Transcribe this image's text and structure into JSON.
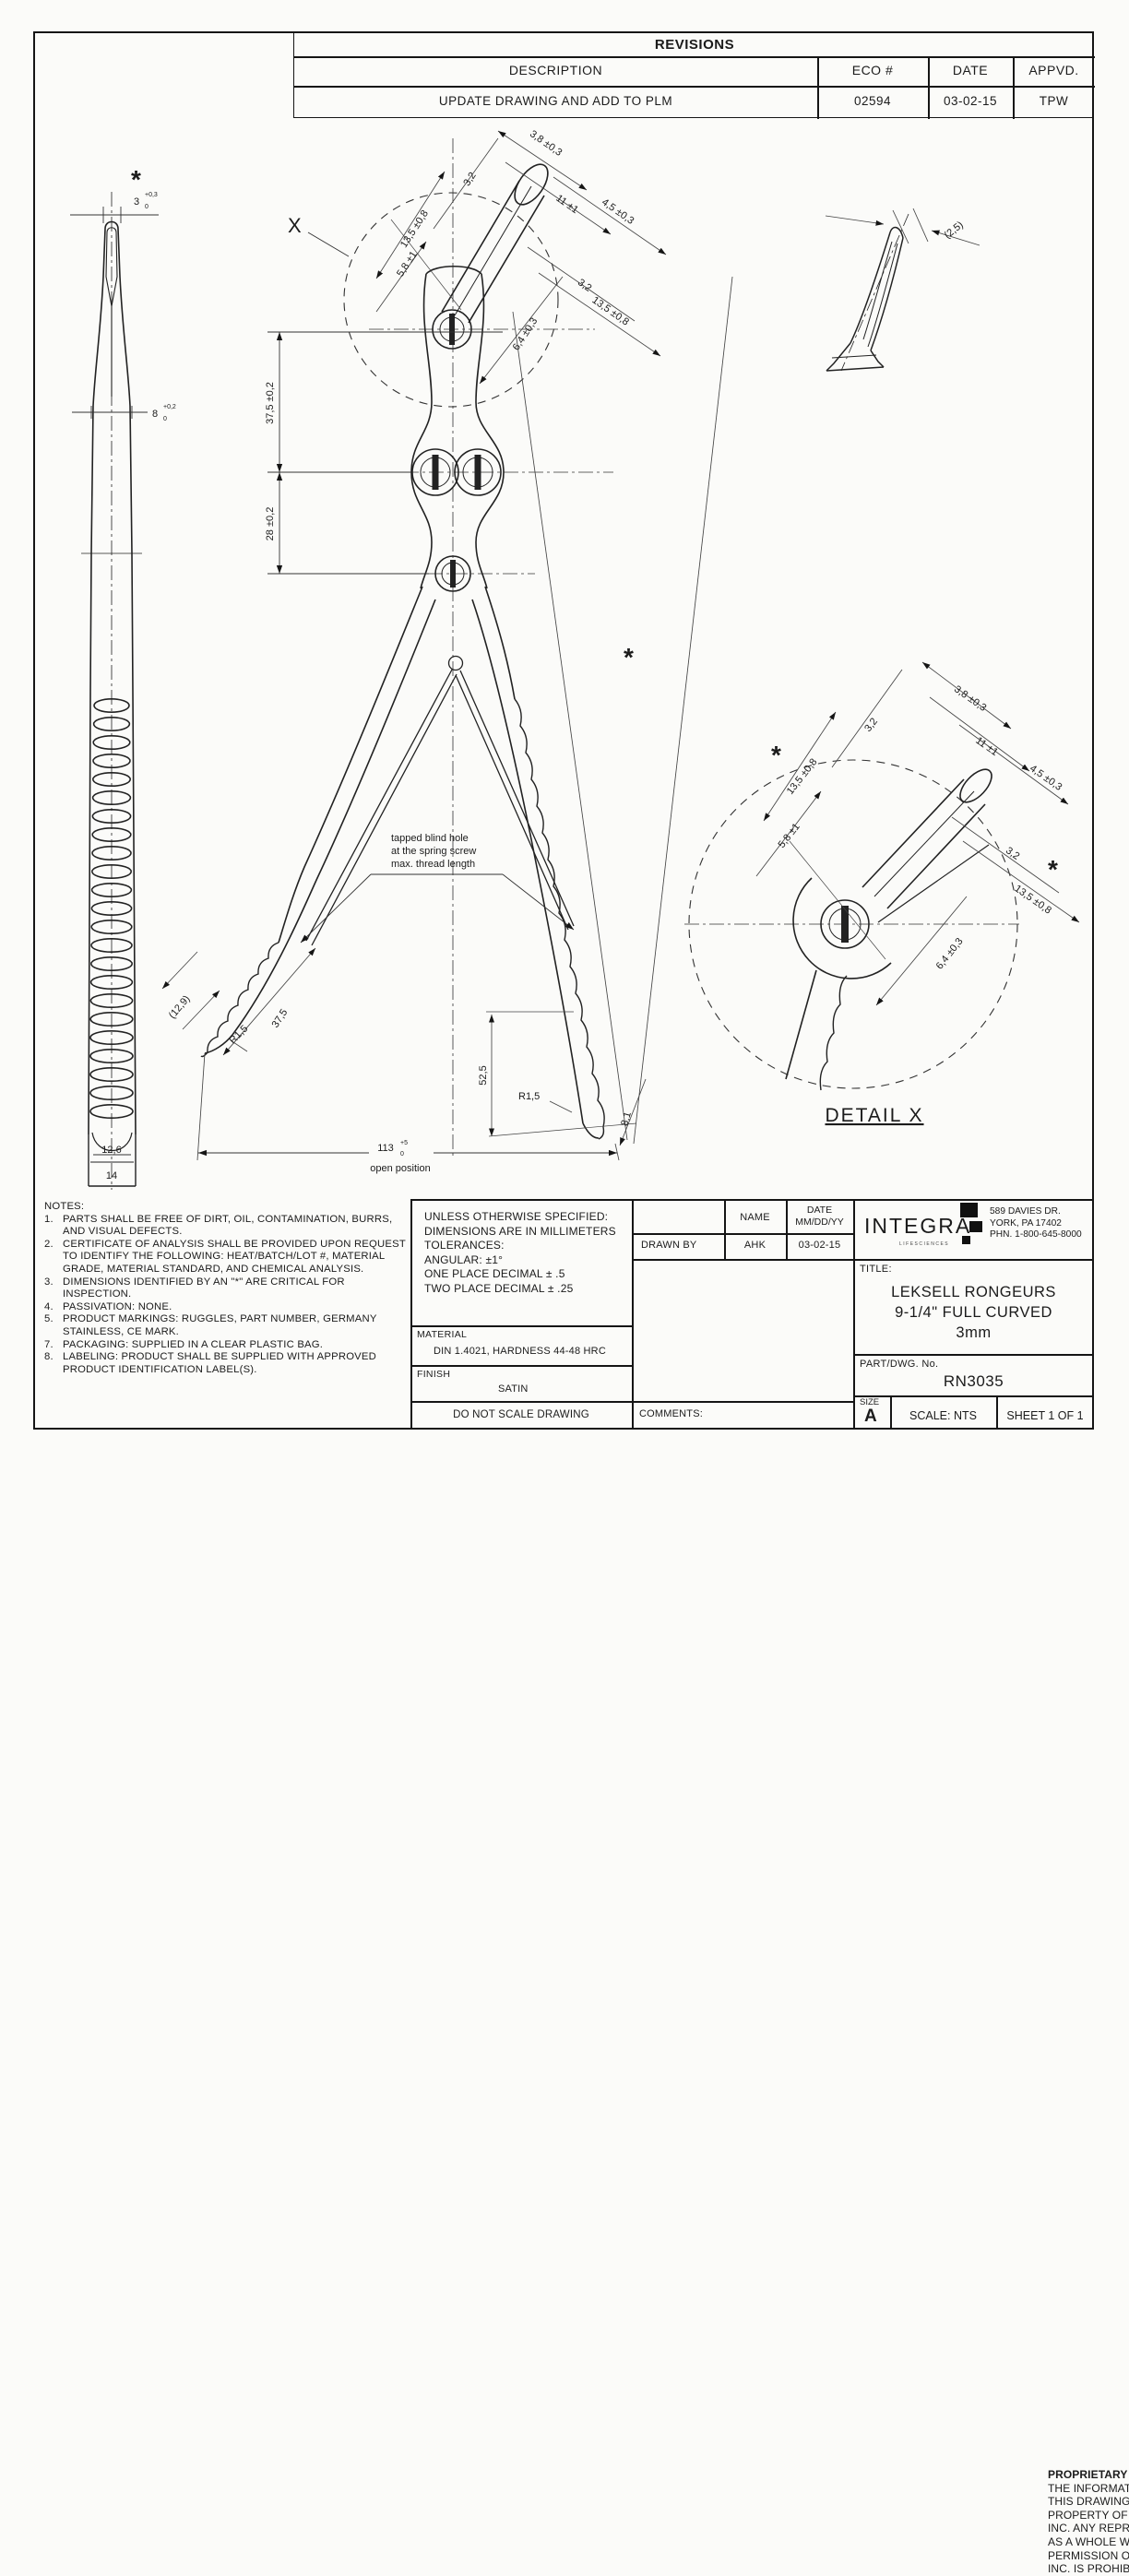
{
  "revisions": {
    "title": "REVISIONS",
    "columns": {
      "description": "DESCRIPTION",
      "eco": "ECO #",
      "date": "DATE",
      "appvd": "APPVD."
    },
    "row": {
      "description": "UPDATE DRAWING AND ADD TO PLM",
      "eco": "02594",
      "date": "03-02-15",
      "appvd": "TPW"
    }
  },
  "drawing": {
    "x_callout": "X",
    "asterisk": "*",
    "detail_label": "DETAIL X",
    "open_position": "open position",
    "tapped_note": {
      "line1": "tapped blind hole",
      "line2": "at the spring screw",
      "line3": "max. thread length"
    },
    "dims": {
      "d3": "3",
      "d3sup": "+0,3",
      "d3sub": "0",
      "d8": "8",
      "d8sup": "+0,2",
      "d8sub": "0",
      "d12_6": "12,6",
      "d14": "14",
      "d37_5t": "37,5 ±0,2",
      "d28": "28 ±0,2",
      "d13_5": "13,5 ±0,8",
      "d3_2": "3,2",
      "d3_8": "3,8 ±0,3",
      "d11": "11 ±1",
      "d4_5": "4,5 ±0,3",
      "d5_8": "5,8 ±1",
      "d6_4": "6,4 ±0,3",
      "d2_5": "(2,5)",
      "d12_9": "(12,9)",
      "r1_5": "R1,5",
      "d37_5": "37,5",
      "d52_5": "52,5",
      "d8_1": "8,1",
      "d113": "113",
      "d113sup": "+5",
      "d113sub": "0"
    }
  },
  "notes": {
    "title": "NOTES:",
    "items": [
      {
        "n": "1.",
        "t": "PARTS SHALL BE FREE OF DIRT, OIL, CONTAMINATION, BURRS, AND VISUAL DEFECTS."
      },
      {
        "n": "2.",
        "t": "CERTIFICATE OF ANALYSIS SHALL BE PROVIDED UPON REQUEST TO IDENTIFY THE FOLLOWING: HEAT/BATCH/LOT #, MATERIAL GRADE, MATERIAL STANDARD, AND CHEMICAL ANALYSIS."
      },
      {
        "n": "3.",
        "t": "DIMENSIONS IDENTIFIED BY AN \"*\" ARE CRITICAL FOR INSPECTION."
      },
      {
        "n": "4.",
        "t": "PASSIVATION: NONE."
      },
      {
        "n": "5.",
        "t": "PRODUCT MARKINGS: RUGGLES, PART NUMBER, GERMANY STAINLESS, CE MARK."
      },
      {
        "n": "7.",
        "t": "PACKAGING: SUPPLIED IN A CLEAR PLASTIC BAG."
      },
      {
        "n": "8.",
        "t": "LABELING: PRODUCT SHALL BE SUPPLIED WITH APPROVED PRODUCT IDENTIFICATION LABEL(S)."
      }
    ]
  },
  "title_block": {
    "tolerances": [
      "UNLESS OTHERWISE SPECIFIED:",
      "DIMENSIONS ARE IN MILLIMETERS",
      "TOLERANCES:",
      "ANGULAR: ±1°",
      "ONE PLACE DECIMAL ± .5",
      "TWO PLACE DECIMAL ± .25"
    ],
    "material_label": "MATERIAL",
    "material": "DIN 1.4021, HARDNESS 44-48 HRC",
    "finish_label": "FINISH",
    "finish": "SATIN",
    "do_not_scale": "DO NOT SCALE DRAWING",
    "name_header": "NAME",
    "date_header1": "DATE",
    "date_header2": "MM/DD/YY",
    "drawn_by_label": "DRAWN BY",
    "drawn_by_name": "AHK",
    "drawn_by_date": "03-02-15",
    "proprietary_title": "PROPRIETARY AND CONFIDENTIAL",
    "proprietary_body": "THE INFORMATION CONTAINED IN THIS DRAWING IS THE SOLE PROPERTY OF INTEGRA YORK PA, INC.  ANY REPRODUCTION IN PART OR AS A WHOLE WITHOUT THE WRITTEN PERMISSION OF INTEGRA YORK PA, INC. IS PROHIBITED.",
    "comments_label": "COMMENTS:",
    "company": {
      "name": "INTEGRA",
      "tagline": "LIFESCIENCES",
      "address1": "589 DAVIES DR.",
      "address2": "YORK, PA 17402",
      "address3": "PHN. 1-800-645-8000"
    },
    "title_label": "TITLE:",
    "title_line1": "LEKSELL RONGEURS",
    "title_line2": "9-1/4\" FULL CURVED",
    "title_line3": "3mm",
    "part_label": "PART/DWG. No.",
    "part_number": "RN3035",
    "size_label": "SIZE",
    "size": "A",
    "scale": "SCALE: NTS",
    "sheet": "SHEET 1 OF 1"
  }
}
